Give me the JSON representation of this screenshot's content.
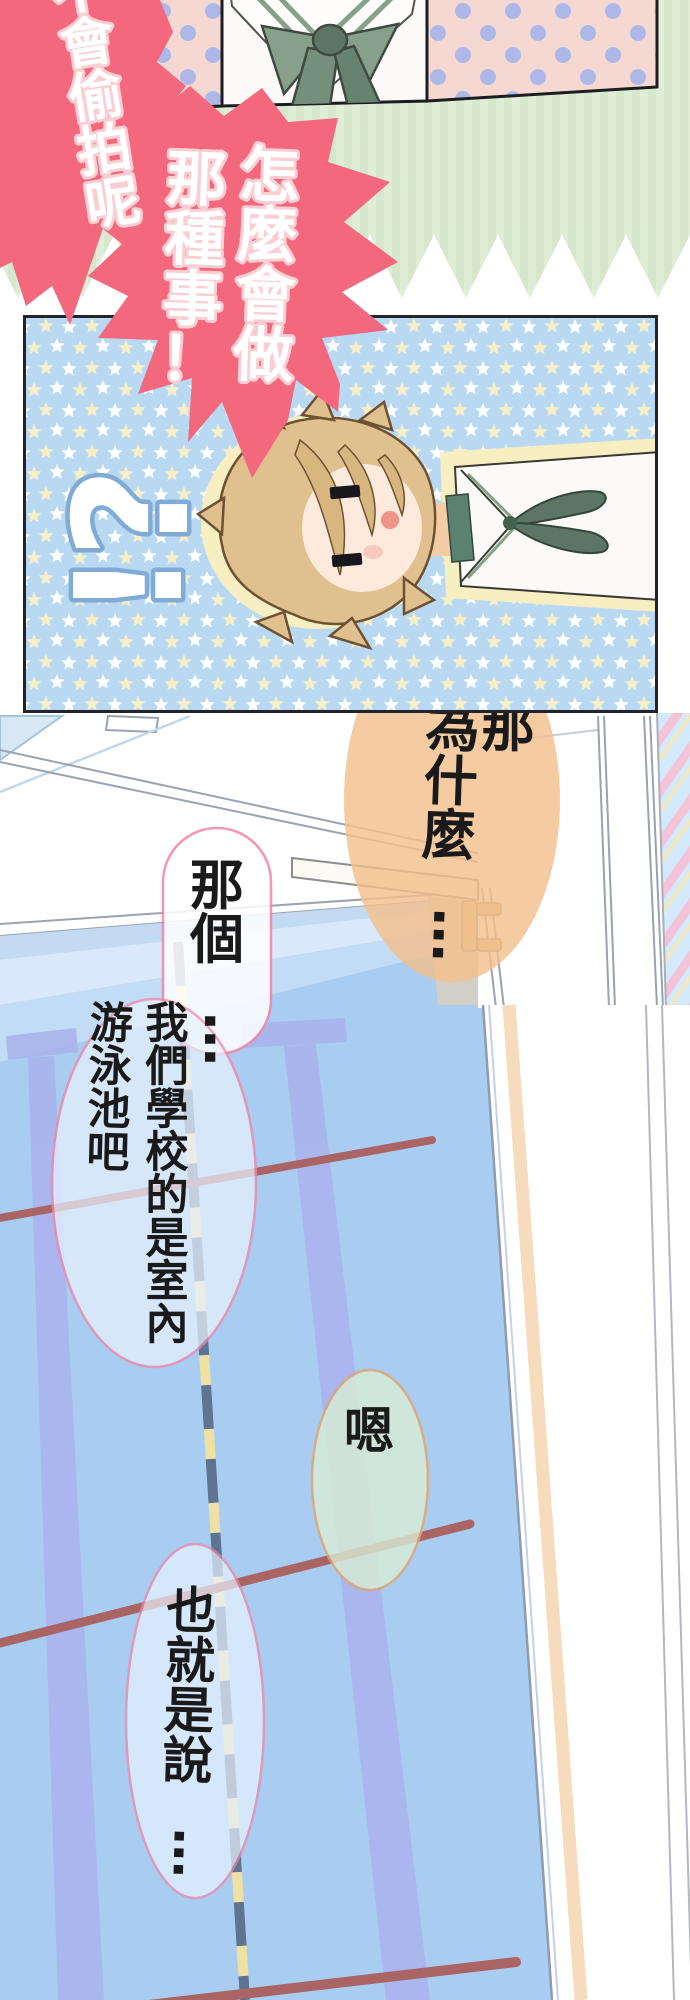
{
  "page_type": "manga-webtoon-strip",
  "speech": {
    "top_left": "不會偷拍呢",
    "main_right": "怎麼會做",
    "main_left": "那種事！",
    "sfx_question": "?",
    "sfx_exclaim": "!",
    "why_right": "那",
    "why_left": "為什麼…",
    "um": "那個…",
    "school_right": "我們學校的是室內",
    "school_left": "游泳池吧",
    "yeah": "嗯",
    "so": "也就是說…"
  },
  "palette": {
    "shout_bubble_pink": "#f4687e",
    "shout_text_outline": "#f9cfd4",
    "green_background": "#dcecd4",
    "polka_panel_pink": "#f5d8d2",
    "polka_dot_lavender": "#aeb8e8",
    "star_panel_blue": "#b9d9f3",
    "star_cream": "#f7efc8",
    "pool_water_blue": "#a8cdf1",
    "lane_stripe_periwinkle": "#aab4ec",
    "lane_rope_maroon": "#aa6464",
    "rope_dash_slate": "#5e7490",
    "rope_dash_yellow": "#efe0a4",
    "bubble_outline_pink": "#f285a8",
    "bubble_outline_orange": "#e3a46c",
    "bubble_orange_fill": "#f3bf8c",
    "bubble_green_fill": "#d9edd5",
    "hair_brown": "#dfc08e",
    "ribbon_green": "#5d7564"
  }
}
